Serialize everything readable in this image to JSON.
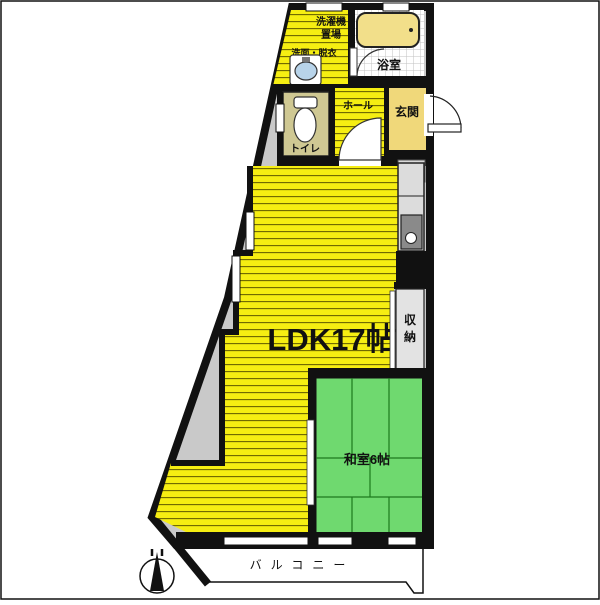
{
  "floorplan": {
    "rooms": {
      "ldk": "LDK17帖",
      "washitsu": "和室6帖",
      "genkan": "玄関",
      "bathroom": "浴室",
      "toilet": "トイレ",
      "hall": "ホール",
      "storage_line1": "収",
      "storage_line2": "納",
      "laundry_line1": "洗濯機",
      "laundry_line2": "置場",
      "washroom": "洗面・脱衣",
      "balcony": "バルコニー"
    },
    "colors": {
      "flooring_yellow": "#f6ee12",
      "stripe_line": "#6b6400",
      "tatami_green": "#6fd96f",
      "tatami_line": "#1d7a1d",
      "genkan_yellow": "#f0d87a",
      "bathtub_yellow": "#f2df8a",
      "toilet_khaki": "#cfc893",
      "wall_black": "#111111",
      "common_gray": "#c9c9c9",
      "counter_gray": "#dcdcdc",
      "sink_gray": "#8a8a8a",
      "basin_blue": "#b8d4ea",
      "step_gray": "#d9d9d9",
      "closet_gray": "#e3e3e3"
    }
  }
}
